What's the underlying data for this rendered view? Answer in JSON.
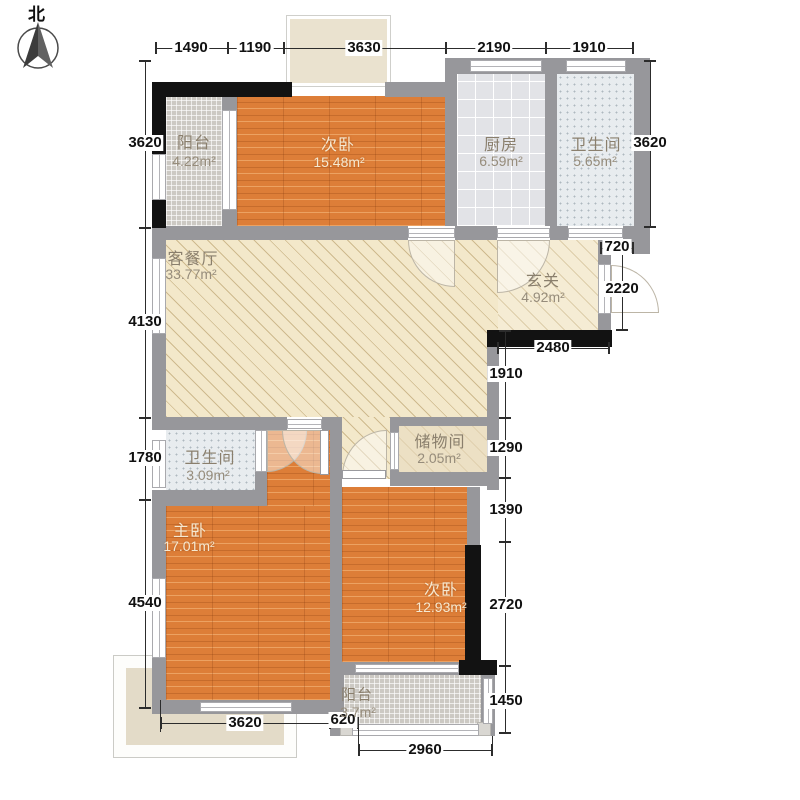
{
  "compass": {
    "north_label": "北"
  },
  "rooms": [
    {
      "id": "balcony-top",
      "name": "阳台",
      "area": "4.22m²"
    },
    {
      "id": "bedroom-top",
      "name": "次卧",
      "area": "15.48m²"
    },
    {
      "id": "kitchen",
      "name": "厨房",
      "area": "6.59m²"
    },
    {
      "id": "bathroom-top",
      "name": "卫生间",
      "area": "5.65m²"
    },
    {
      "id": "living-dining",
      "name": "客餐厅",
      "area": "33.77m²"
    },
    {
      "id": "entry",
      "name": "玄关",
      "area": "4.92m²"
    },
    {
      "id": "bathroom-mid",
      "name": "卫生间",
      "area": "3.09m²"
    },
    {
      "id": "storage",
      "name": "储物间",
      "area": "2.05m²"
    },
    {
      "id": "master-bedroom",
      "name": "主卧",
      "area": "17.01m²"
    },
    {
      "id": "bedroom-bottom",
      "name": "次卧",
      "area": "12.93m²"
    },
    {
      "id": "balcony-bottom",
      "name": "阳台",
      "area": "3.7m²"
    }
  ],
  "dimensions": {
    "top": [
      "1490",
      "1190",
      "3630",
      "2190",
      "1910"
    ],
    "left": [
      "3620",
      "4130",
      "1780",
      "4540"
    ],
    "right_top": [
      "3620"
    ],
    "right_upper": [
      "720",
      "2220",
      "2480"
    ],
    "right_mid": [
      "1910",
      "1290",
      "1390",
      "2720",
      "1450"
    ],
    "bottom": [
      "3620",
      "620",
      "2960"
    ]
  }
}
